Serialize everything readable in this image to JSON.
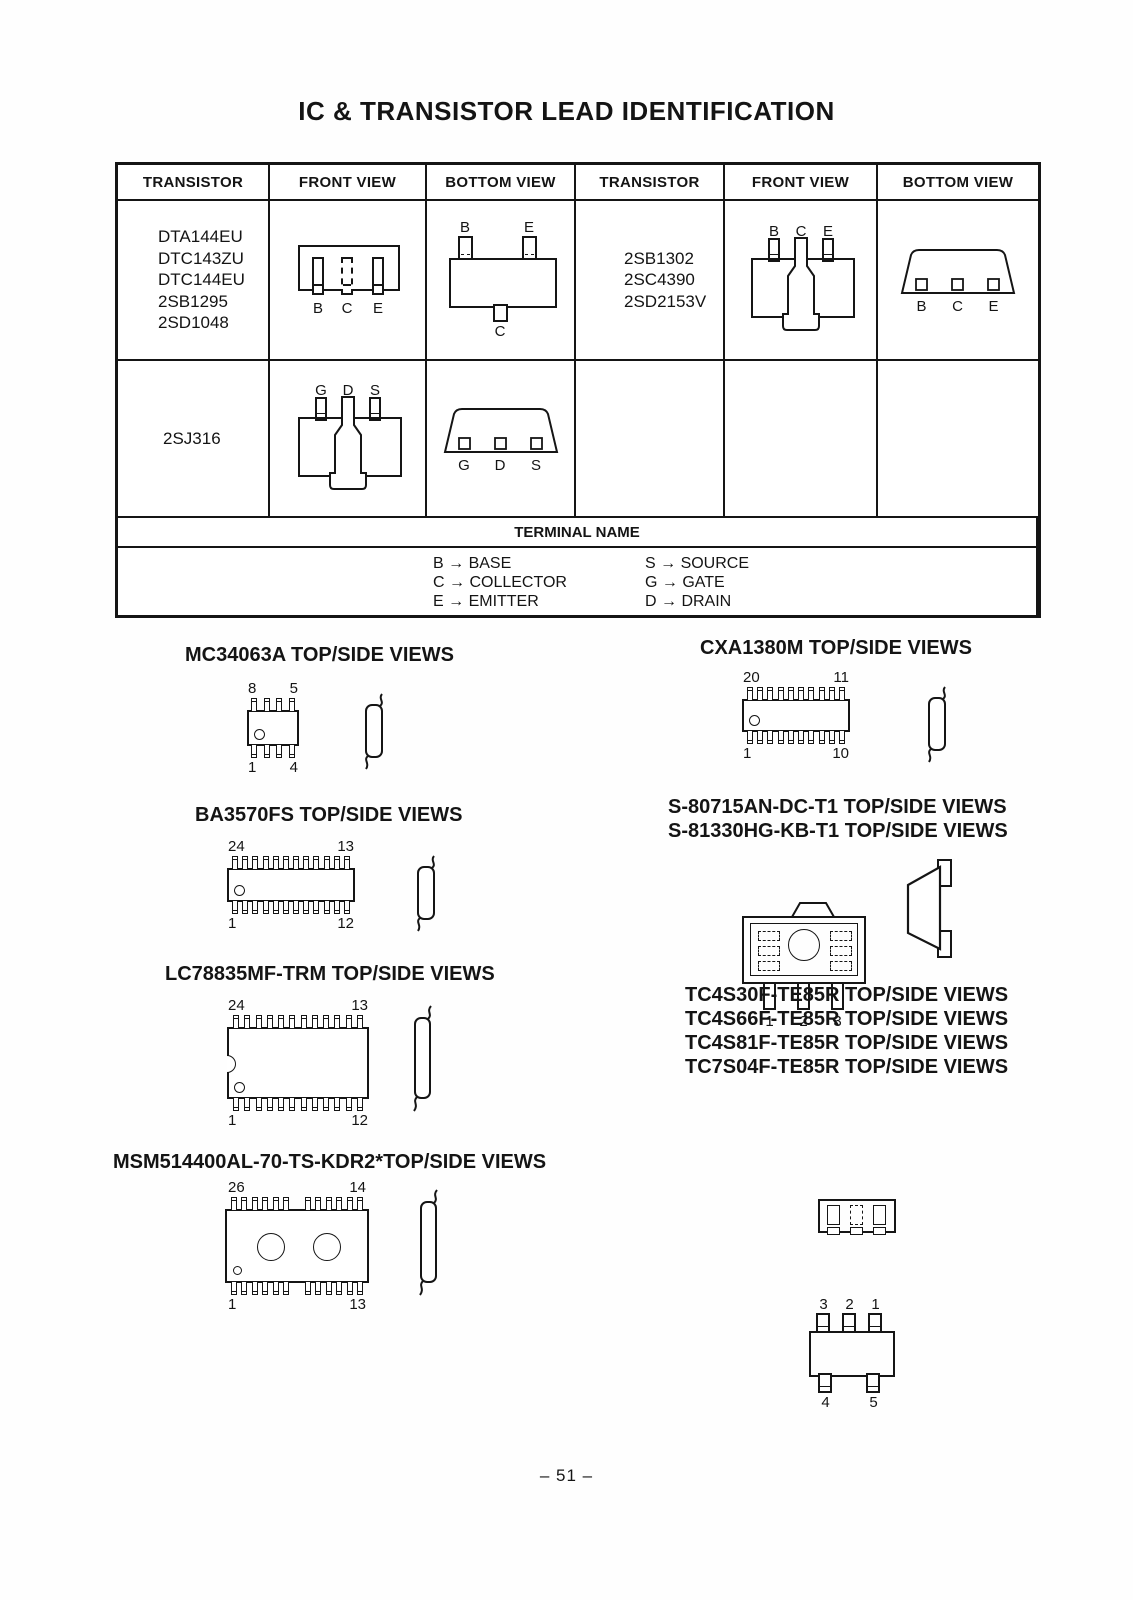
{
  "title": "IC & TRANSISTOR LEAD IDENTIFICATION",
  "table": {
    "headers": [
      "TRANSISTOR",
      "FRONT VIEW",
      "BOTTOM VIEW",
      "TRANSISTOR",
      "FRONT VIEW",
      "BOTTOM VIEW"
    ],
    "group1": {
      "parts": [
        "DTA144EU",
        "DTC143ZU",
        "DTC144EU",
        "2SB1295",
        "2SD1048"
      ],
      "front_labels": [
        "B",
        "C",
        "E"
      ],
      "bottom_top_labels": [
        "B",
        "E"
      ],
      "bottom_bottom_label": "C"
    },
    "group2": {
      "parts": [
        "2SB1302",
        "2SC4390",
        "2SD2153V"
      ],
      "front_labels": [
        "B",
        "C",
        "E"
      ],
      "bottom_labels": [
        "B",
        "C",
        "E"
      ]
    },
    "group3": {
      "part": "2SJ316",
      "front_labels": [
        "G",
        "D",
        "S"
      ],
      "bottom_labels": [
        "G",
        "D",
        "S"
      ]
    },
    "terminal": {
      "header": "TERMINAL NAME",
      "left": [
        "B → BASE",
        "C → COLLECTOR",
        "E → EMITTER"
      ],
      "right": [
        "S → SOURCE",
        "G → GATE",
        "D → DRAIN"
      ]
    }
  },
  "sections": {
    "mc34063a": {
      "title": "MC34063A TOP/SIDE VIEWS",
      "tl": "8",
      "tr": "5",
      "bl": "1",
      "br": "4"
    },
    "cxa1380m": {
      "title": "CXA1380M TOP/SIDE VIEWS",
      "tl": "20",
      "tr": "11",
      "bl": "1",
      "br": "10"
    },
    "ba3570fs": {
      "title": "BA3570FS TOP/SIDE VIEWS",
      "tl": "24",
      "tr": "13",
      "bl": "1",
      "br": "12"
    },
    "s80715": {
      "titles": [
        "S-80715AN-DC-T1 TOP/SIDE VIEWS",
        "S-81330HG-KB-T1 TOP/SIDE VIEWS"
      ],
      "pins": [
        "1",
        "2",
        "3"
      ]
    },
    "lc78835": {
      "title": "LC78835MF-TRM TOP/SIDE VIEWS",
      "tl": "24",
      "tr": "13",
      "bl": "1",
      "br": "12"
    },
    "tc4s": {
      "titles": [
        "TC4S30F-TE85R TOP/SIDE VIEWS",
        "TC4S66F-TE85R TOP/SIDE VIEWS",
        "TC4S81F-TE85R TOP/SIDE VIEWS",
        "TC7S04F-TE85R TOP/SIDE VIEWS"
      ],
      "top_pins": [
        "3",
        "2",
        "1"
      ],
      "bottom_pins": [
        "4",
        "5"
      ]
    },
    "msm514400": {
      "title": "MSM514400AL-70-TS-KDR2*TOP/SIDE VIEWS",
      "tl": "26",
      "tr": "14",
      "bl": "1",
      "br": "13"
    }
  },
  "page_number": "– 51 –"
}
